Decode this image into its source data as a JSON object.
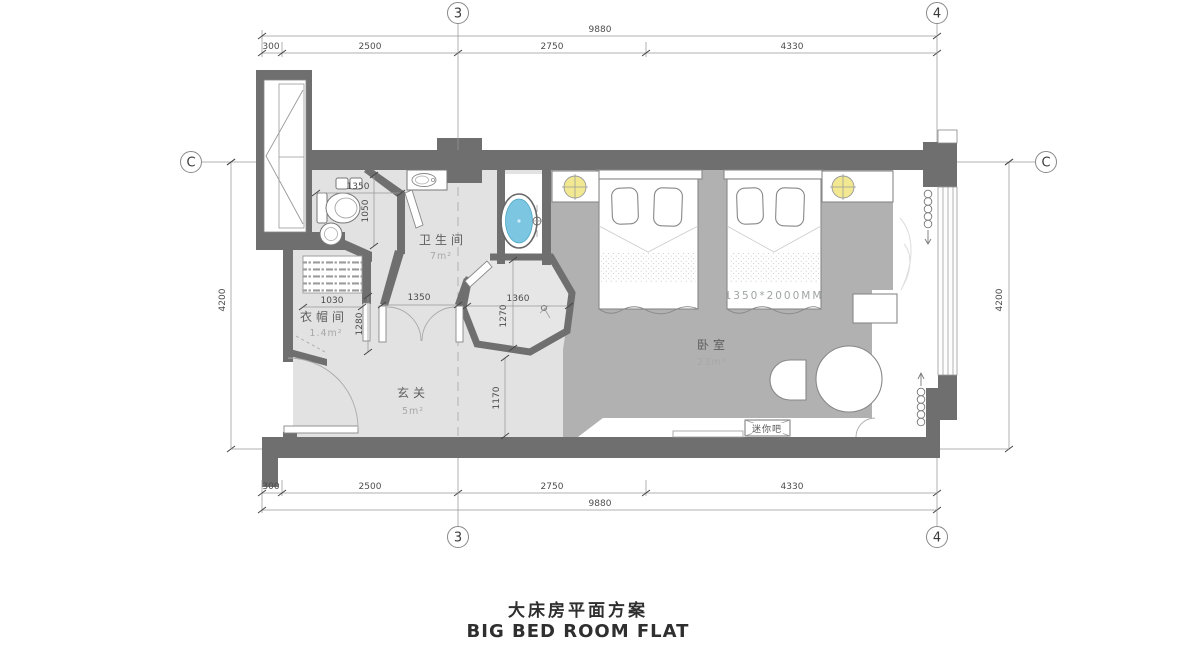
{
  "title": {
    "cn": "大床房平面方案",
    "en": "BIG BED ROOM FLAT"
  },
  "grid": {
    "axis3": "3",
    "axis4": "4",
    "axisC": "C"
  },
  "dims": {
    "overall_width": "9880",
    "left_offset": "300",
    "seg_entry": "2500",
    "seg_mid": "2750",
    "seg_bed": "4330",
    "overall_depth": "4200"
  },
  "interior_dims": {
    "wc_width": "1350",
    "wc_depth": "1050",
    "cloak_width": "1030",
    "cloak_depth": "1280",
    "double_door": "1350",
    "shower_width": "1360",
    "shower_depth": "1270",
    "entry_depth": "1170"
  },
  "rooms": {
    "bathroom_name": "卫生间",
    "bathroom_area": "7m²",
    "cloak_name": "衣帽间",
    "cloak_area": "1.4m²",
    "entry_name": "玄关",
    "entry_area": "5m²",
    "bedroom_name": "卧室",
    "bedroom_area": "23m²"
  },
  "annotations": {
    "bed_size": "1350*2000MM",
    "minibar": "迷你吧"
  },
  "colors": {
    "wall": "#6f6f6f",
    "floor_light": "#e2e2e2",
    "floor_bedroom": "#b1b1b1",
    "floor_shower": "#e6e6e6",
    "bathtub": "#7cc6e2",
    "lamp": "#f2e891"
  }
}
